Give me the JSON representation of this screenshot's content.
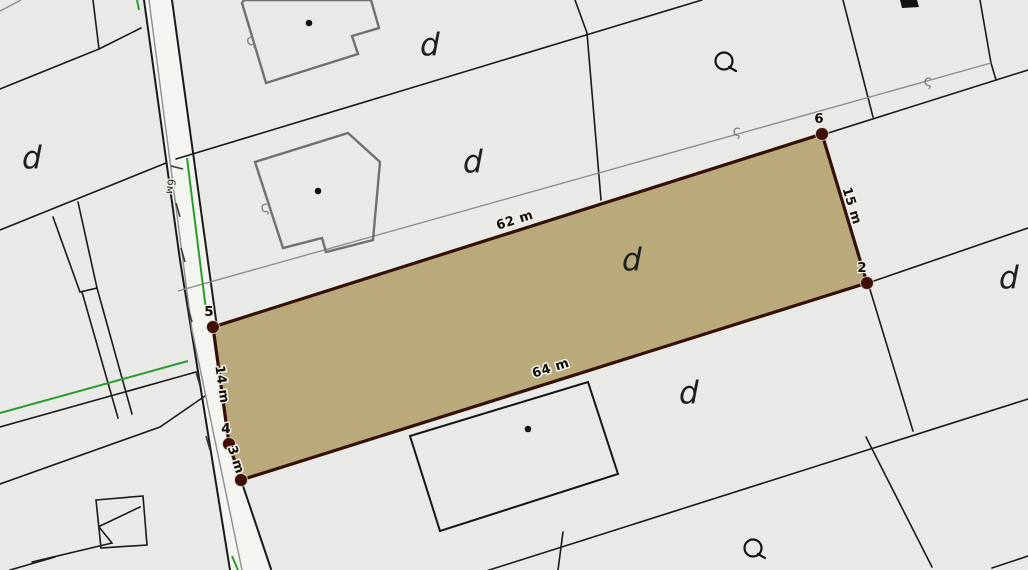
{
  "map": {
    "type": "cadastral-parcel-map",
    "colors": {
      "background": "#e9e9e7",
      "road_fill": "#f4f4f1",
      "boundary_line": "#1a1a1a",
      "old_boundary_line": "#8d8d8d",
      "green_line": "#2c9a2c",
      "building_outline": "#707070",
      "parcel_fill": "#b5a372",
      "parcel_border": "#330f05",
      "vertex_dot": "#400f06",
      "label_ink": "#140b05"
    },
    "selected_parcel": {
      "vertices": [
        {
          "label": "5",
          "x": 213,
          "y": 327,
          "lx": 209,
          "ly": 316
        },
        {
          "label": "6",
          "x": 822,
          "y": 134,
          "lx": 819,
          "ly": 123
        },
        {
          "label": "2",
          "x": 867,
          "y": 283,
          "lx": 862,
          "ly": 272
        },
        {
          "label": "",
          "x": 241,
          "y": 480,
          "lx": 0,
          "ly": 0
        },
        {
          "label": "4",
          "x": 229,
          "y": 444,
          "lx": 226,
          "ly": 433
        }
      ],
      "edge_labels": [
        {
          "text": "62 m",
          "x": 516,
          "y": 224,
          "rotation": -17.6
        },
        {
          "text": "15 m",
          "x": 848,
          "y": 207,
          "rotation": 73
        },
        {
          "text": "64 m",
          "x": 552,
          "y": 372,
          "rotation": -17.5
        },
        {
          "text": "14 m",
          "x": 218,
          "y": 385,
          "rotation": 82
        },
        {
          "text": "3 m",
          "x": 232,
          "y": 461,
          "rotation": 72
        }
      ]
    },
    "land_use_labels": [
      {
        "text": "d",
        "x": 22,
        "y": 168
      },
      {
        "text": "d",
        "x": 420,
        "y": 55
      },
      {
        "text": "d",
        "x": 463,
        "y": 172
      },
      {
        "text": "d",
        "x": 622,
        "y": 270
      },
      {
        "text": "d",
        "x": 679,
        "y": 403
      },
      {
        "text": "d",
        "x": 999,
        "y": 288
      }
    ],
    "road_label": {
      "text": "6м",
      "x": 167,
      "y": 186,
      "rotation": 98
    },
    "symbols": {
      "circle_tail_symbols": [
        {
          "x": 724,
          "y": 61
        },
        {
          "x": 753,
          "y": 548
        }
      ],
      "squiggle_symbols": [
        {
          "text": "ς",
          "x": 252,
          "y": 45,
          "rotation": -18
        },
        {
          "text": "ς",
          "x": 266,
          "y": 212,
          "rotation": -15
        },
        {
          "text": "ς",
          "x": 737,
          "y": 136,
          "rotation": 0
        },
        {
          "text": "ς",
          "x": 928,
          "y": 86,
          "rotation": 0
        }
      ],
      "building_center_dots": [
        {
          "x": 309,
          "y": 23
        },
        {
          "x": 318,
          "y": 191
        },
        {
          "x": 528,
          "y": 429
        }
      ]
    }
  }
}
